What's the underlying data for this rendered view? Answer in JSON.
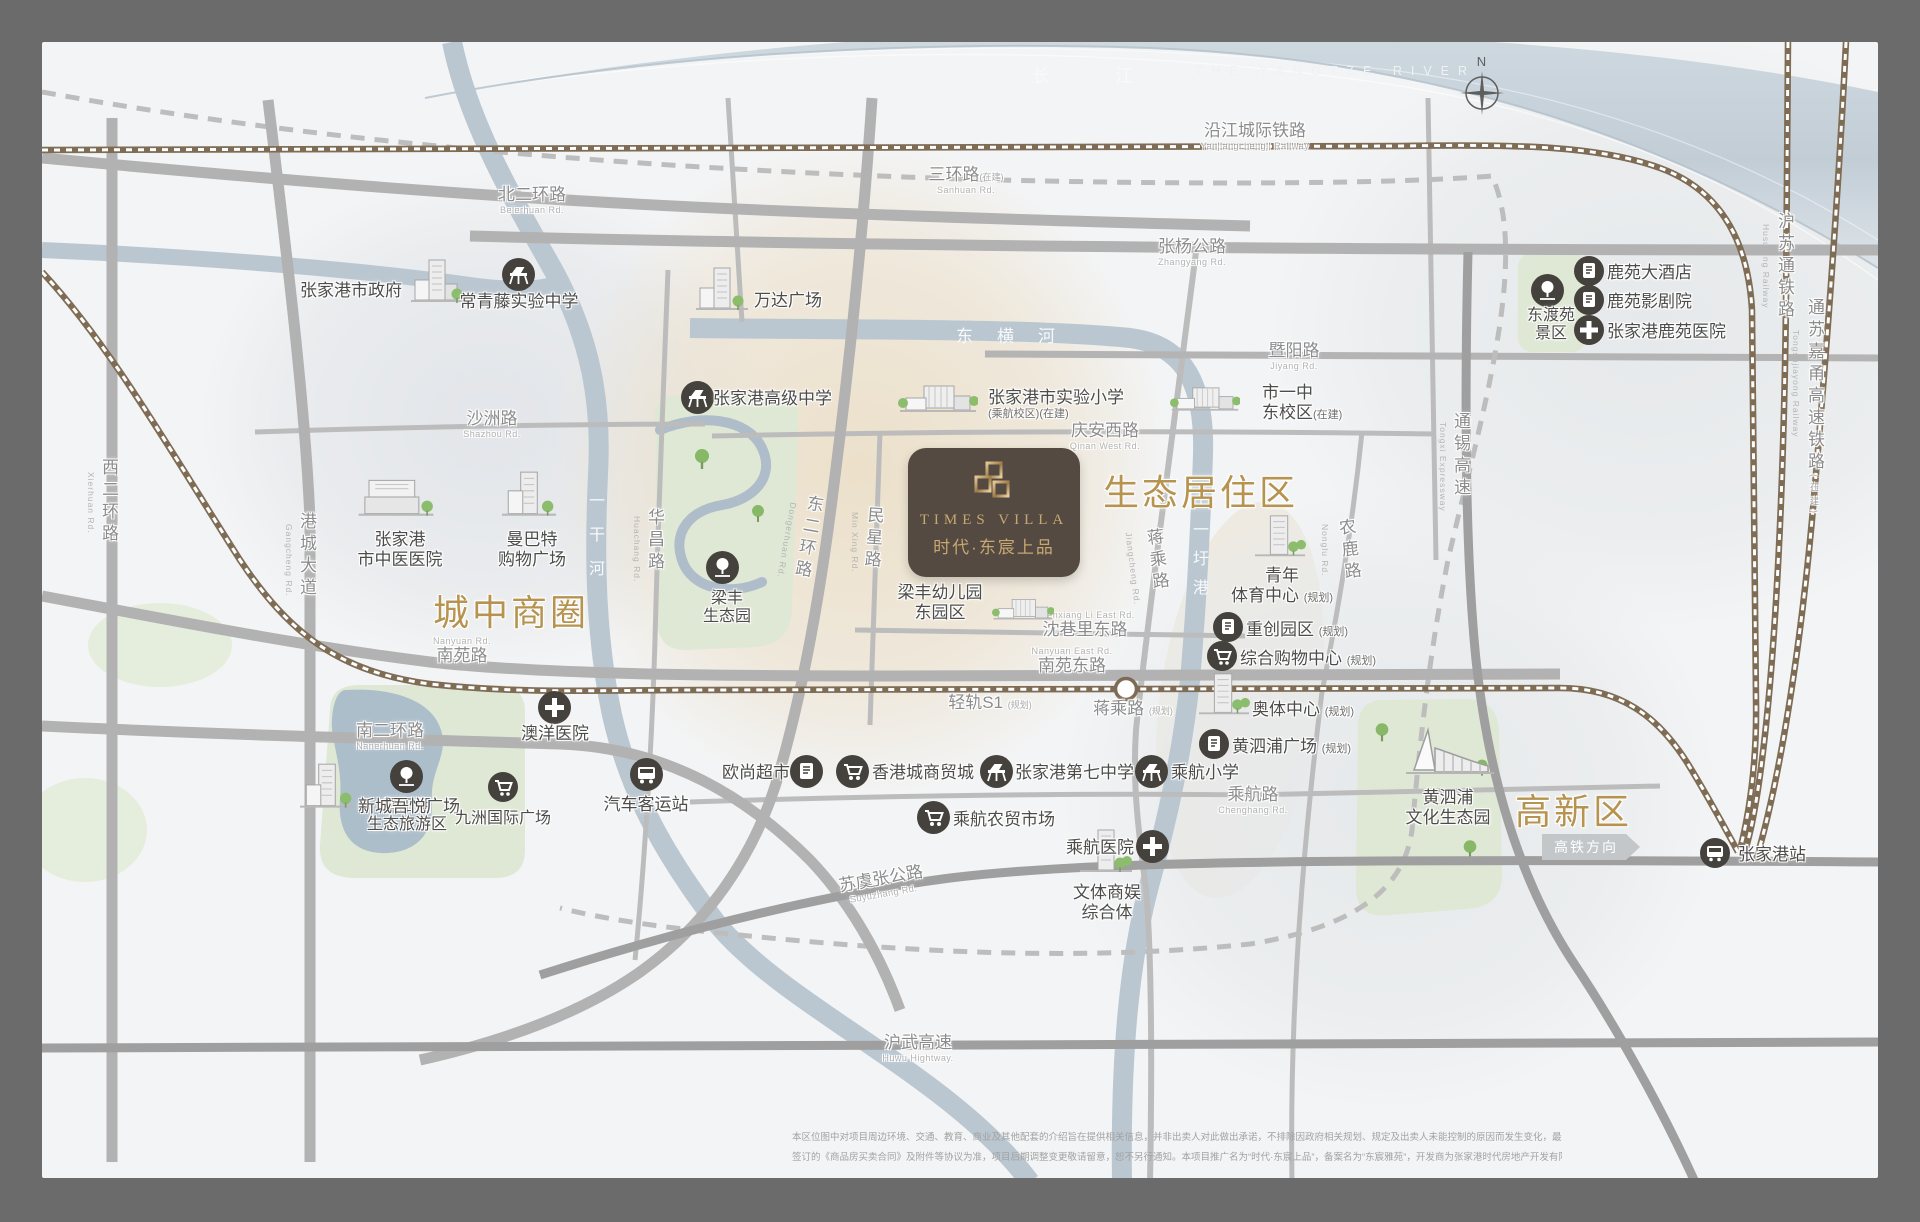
{
  "compass": {
    "n": "N"
  },
  "yangtze": {
    "cn": "长  江",
    "en": "THE YANGTZE RIVER"
  },
  "zones": {
    "downtown": "城中商圈",
    "eco_residential": "生态居住区",
    "hightech": "高新区"
  },
  "logo": {
    "en": "TIMES VILLA",
    "cn": "时代·东宸上品"
  },
  "rivers": {
    "donghenghe": "东横河",
    "yiganhe": "一干河",
    "shiyiweigang": "十一圩港"
  },
  "railways": {
    "yanjiang": {
      "cn": "沿江城际铁路",
      "en": "Yanjiangchengji Railway"
    },
    "husutong": {
      "cn": "沪苏通铁路",
      "en": "Husutong Railway"
    },
    "tongsujiayong": {
      "cn": "通苏嘉甬高速铁路",
      "tag": "(在建)",
      "en": "Tongsujiayong Railway"
    },
    "light_rail_s1": {
      "cn": "轻轨S1",
      "tag": "(规划)"
    },
    "jiangcheng_station": {
      "cn": "蒋乘路",
      "tag": "(规划)"
    },
    "hsr_direction": "高铁方向",
    "zjg_station": "张家港站"
  },
  "roads": {
    "beierhuan": {
      "cn": "北二环路",
      "en": "Beierhuan Rd."
    },
    "sanhuan": {
      "cn": "三环路",
      "tag": "(在建)",
      "en": "Sanhuan Rd."
    },
    "zhangyang": {
      "cn": "张杨公路",
      "en": "Zhangyang Rd."
    },
    "jiyang": {
      "cn": "暨阳路",
      "en": "Jiyang Rd."
    },
    "shazhou": {
      "cn": "沙洲路",
      "en": "Shazhou Rd."
    },
    "qinan_west": {
      "cn": "庆安西路",
      "en": "Qinan West Rd."
    },
    "shenxiangli_east": {
      "cn": "沈巷里东路",
      "en": "Shenxiang Li East Rd."
    },
    "nanyuan": {
      "cn": "南苑路",
      "en": "Nanyuan Rd."
    },
    "nanyuan_east": {
      "cn": "南苑东路",
      "en": "Nanyuan East Rd."
    },
    "chenghang": {
      "cn": "乘航路",
      "en": "Chenghang Rd."
    },
    "suyuzhang": {
      "cn": "苏虞张公路",
      "en": "Suyuzhang Rd."
    },
    "nanerhuan": {
      "cn": "南二环路",
      "en": "Nanerhuan Rd."
    },
    "huwu": {
      "cn": "沪武高速",
      "en": "Huwu Hightway."
    },
    "xierhuan": {
      "cn": "西二环路",
      "en": "Xierhuan Rd."
    },
    "gangcheng": {
      "cn": "港城大道",
      "en": "Gangcheng Rd."
    },
    "huachang": {
      "cn": "华昌路",
      "en": "Huachang Rd."
    },
    "dongerhuan": {
      "cn": "东二环路",
      "en": "Dongerhuan Rd."
    },
    "minxing": {
      "cn": "民星路",
      "en": "Min Xing Rd."
    },
    "jiangcheng": {
      "cn": "蒋乘路",
      "en": "Jiangcheng Rd."
    },
    "nonglu": {
      "cn": "农鹿路",
      "en": "Nonglu Rd."
    },
    "tongxi": {
      "cn": "通锡高速",
      "en": "Tongxi Expressway"
    }
  },
  "pois": {
    "gov": {
      "label": "张家港市政府"
    },
    "ivy_school": {
      "label": "常青藤实验中学"
    },
    "wanda": {
      "label": "万达广场"
    },
    "zjg_high_school": {
      "label": "张家港高级中学"
    },
    "experimental_primary": {
      "label": "张家港市实验小学",
      "tag": "(乘航校区)(在建)"
    },
    "no1_middle_east": {
      "label": "市一中",
      "label2": "东校区",
      "tag": "(在建)"
    },
    "dongduyuan": {
      "label": "东渡苑",
      "label2": "景区"
    },
    "luyuan_hotel": {
      "label": "鹿苑大酒店"
    },
    "luyuan_theater": {
      "label": "鹿苑影剧院"
    },
    "luyuan_hospital": {
      "label": "张家港鹿苑医院"
    },
    "tcm_hospital": {
      "label": "张家港",
      "label2": "市中医医院"
    },
    "manbate": {
      "label": "曼巴特",
      "label2": "购物广场"
    },
    "liangfeng_park": {
      "label": "梁丰",
      "label2": "生态园"
    },
    "liangfeng_kindergarten": {
      "label": "梁丰幼儿园",
      "label2": "东园区"
    },
    "youth_sports": {
      "label": "青年",
      "label2": "体育中心",
      "tag": "(规划)"
    },
    "zhongchuang_park": {
      "label": "重创园区",
      "tag": "(规划)"
    },
    "composite_mall": {
      "label": "综合购物中心",
      "tag": "(规划)"
    },
    "aoti_center": {
      "label": "奥体中心",
      "tag": "(规划)"
    },
    "huangsipu_plaza": {
      "label": "黄泗浦广场",
      "tag": "(规划)"
    },
    "aoyang_hospital": {
      "label": "澳洋医院"
    },
    "jiyang_lake": {
      "label": "暨阳湖",
      "label2": "生态旅游区"
    },
    "bus_terminal": {
      "label": "汽车客运站"
    },
    "auchan": {
      "label": "欧尚超市"
    },
    "hk_city_mall": {
      "label": "香港城商贸城"
    },
    "no7_middle": {
      "label": "张家港第七中学"
    },
    "chenghang_primary": {
      "label": "乘航小学"
    },
    "chenghang_market": {
      "label": "乘航农贸市场"
    },
    "chenghang_hospital": {
      "label": "乘航医院"
    },
    "wenti_complex": {
      "label": "文体商娱",
      "label2": "综合体"
    },
    "huangsipu_park": {
      "label": "黄泗浦",
      "label2": "文化生态园"
    },
    "wuyue_plaza": {
      "label": "新城吾悦广场"
    },
    "jiuzhou_plaza": {
      "label": "九洲国际广场"
    }
  },
  "disclaimer": {
    "line1": "本区位图中对项目周边环境、交通、教育、商业及其他配套的介绍旨在提供相关信息，并非出卖人对此做出承诺，不排除因政府相关规划、规定及出卖人未能控制的原因而发生变化，最终以项目交付时的周边现状为准。本区位图所展示的内容仅为示意参考，均不作为公司承诺，买卖双方的权利义务最终以双方",
    "line2": "签订的《商品房买卖合同》及附件等协议为准，项目后期调整变更敬请留意，恕不另行通知。本项目推广名为“时代·东宸上品”，备案名为“东宸雅苑”，开发商为张家港时代房地产开发有限公司。本区位图制作于2021年11月5日，出卖人会不定期对区位图进行修改，敬请关注最新资料。"
  }
}
